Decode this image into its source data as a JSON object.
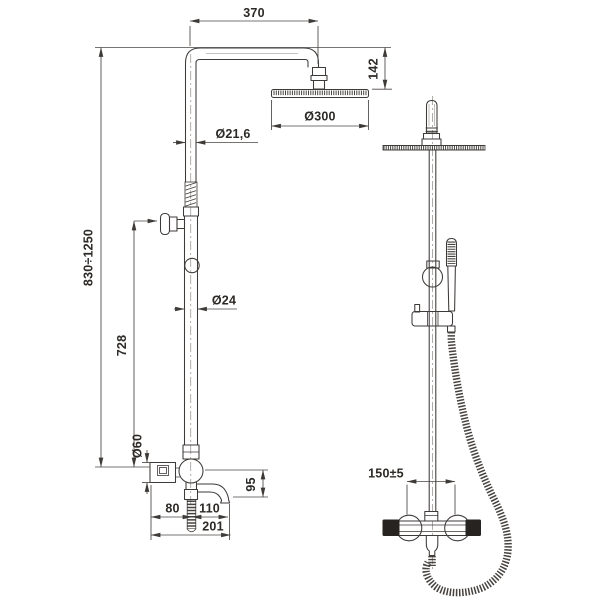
{
  "document": {
    "type": "technical-drawing shower column, two views",
    "background": "#ffffff",
    "line_color": "#3d3a38",
    "text_color": "#2c2926",
    "handle_color": "#272320"
  },
  "front_view": {
    "name": "dimensioned front elevation",
    "dims": {
      "arm_reach": "370",
      "head_drop": "142",
      "head_diameter": "Ø300",
      "upper_pipe_diameter": "Ø21,6",
      "column_height_range": "830÷1250",
      "holder_to_valve_height": "728",
      "lower_pipe_diameter": "Ø24",
      "valve_body_diameter": "Ø60",
      "spout_drop": "95",
      "wall_to_riser": "80",
      "riser_to_spout_tip": "110",
      "wall_to_spout_tip": "201"
    }
  },
  "side_view": {
    "name": "side elevation with hand shower and hose",
    "dims": {
      "inlet_centers_spacing": "150±5"
    }
  }
}
